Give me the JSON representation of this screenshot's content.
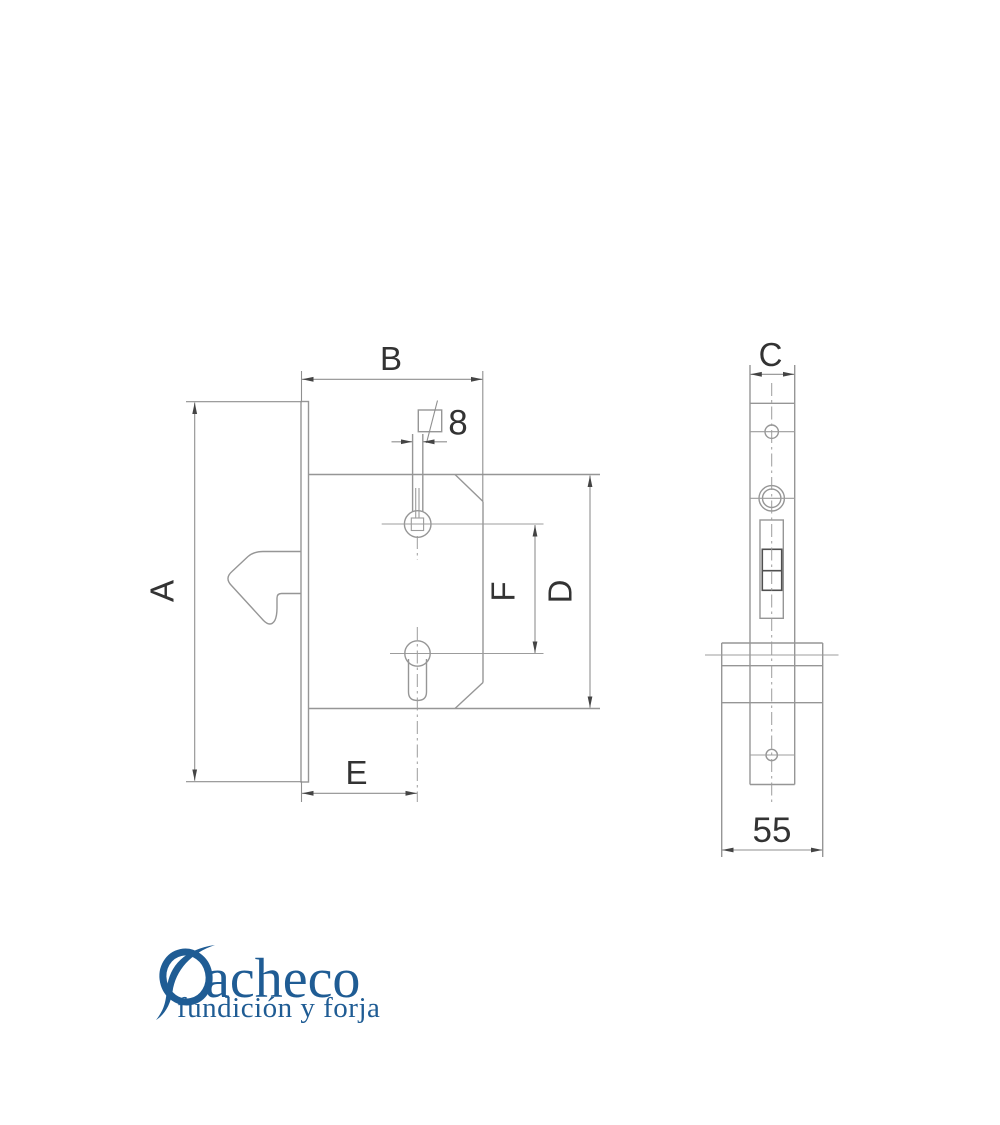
{
  "colors": {
    "background": "#ffffff",
    "outline": "#969696",
    "dark_detail": "#4f4f4f",
    "dimension_line": "#8f8f8f",
    "dimension_text": "#333333",
    "logo_blue": "#1f5c94"
  },
  "dimensions": {
    "A": "A",
    "B": "B",
    "C": "C",
    "D": "D",
    "E": "E",
    "F": "F",
    "spindle_square": "8",
    "body_width": "55"
  },
  "logo": {
    "name": "Pacheco",
    "name_tail": "acheco",
    "tagline": "fundición y forja"
  }
}
